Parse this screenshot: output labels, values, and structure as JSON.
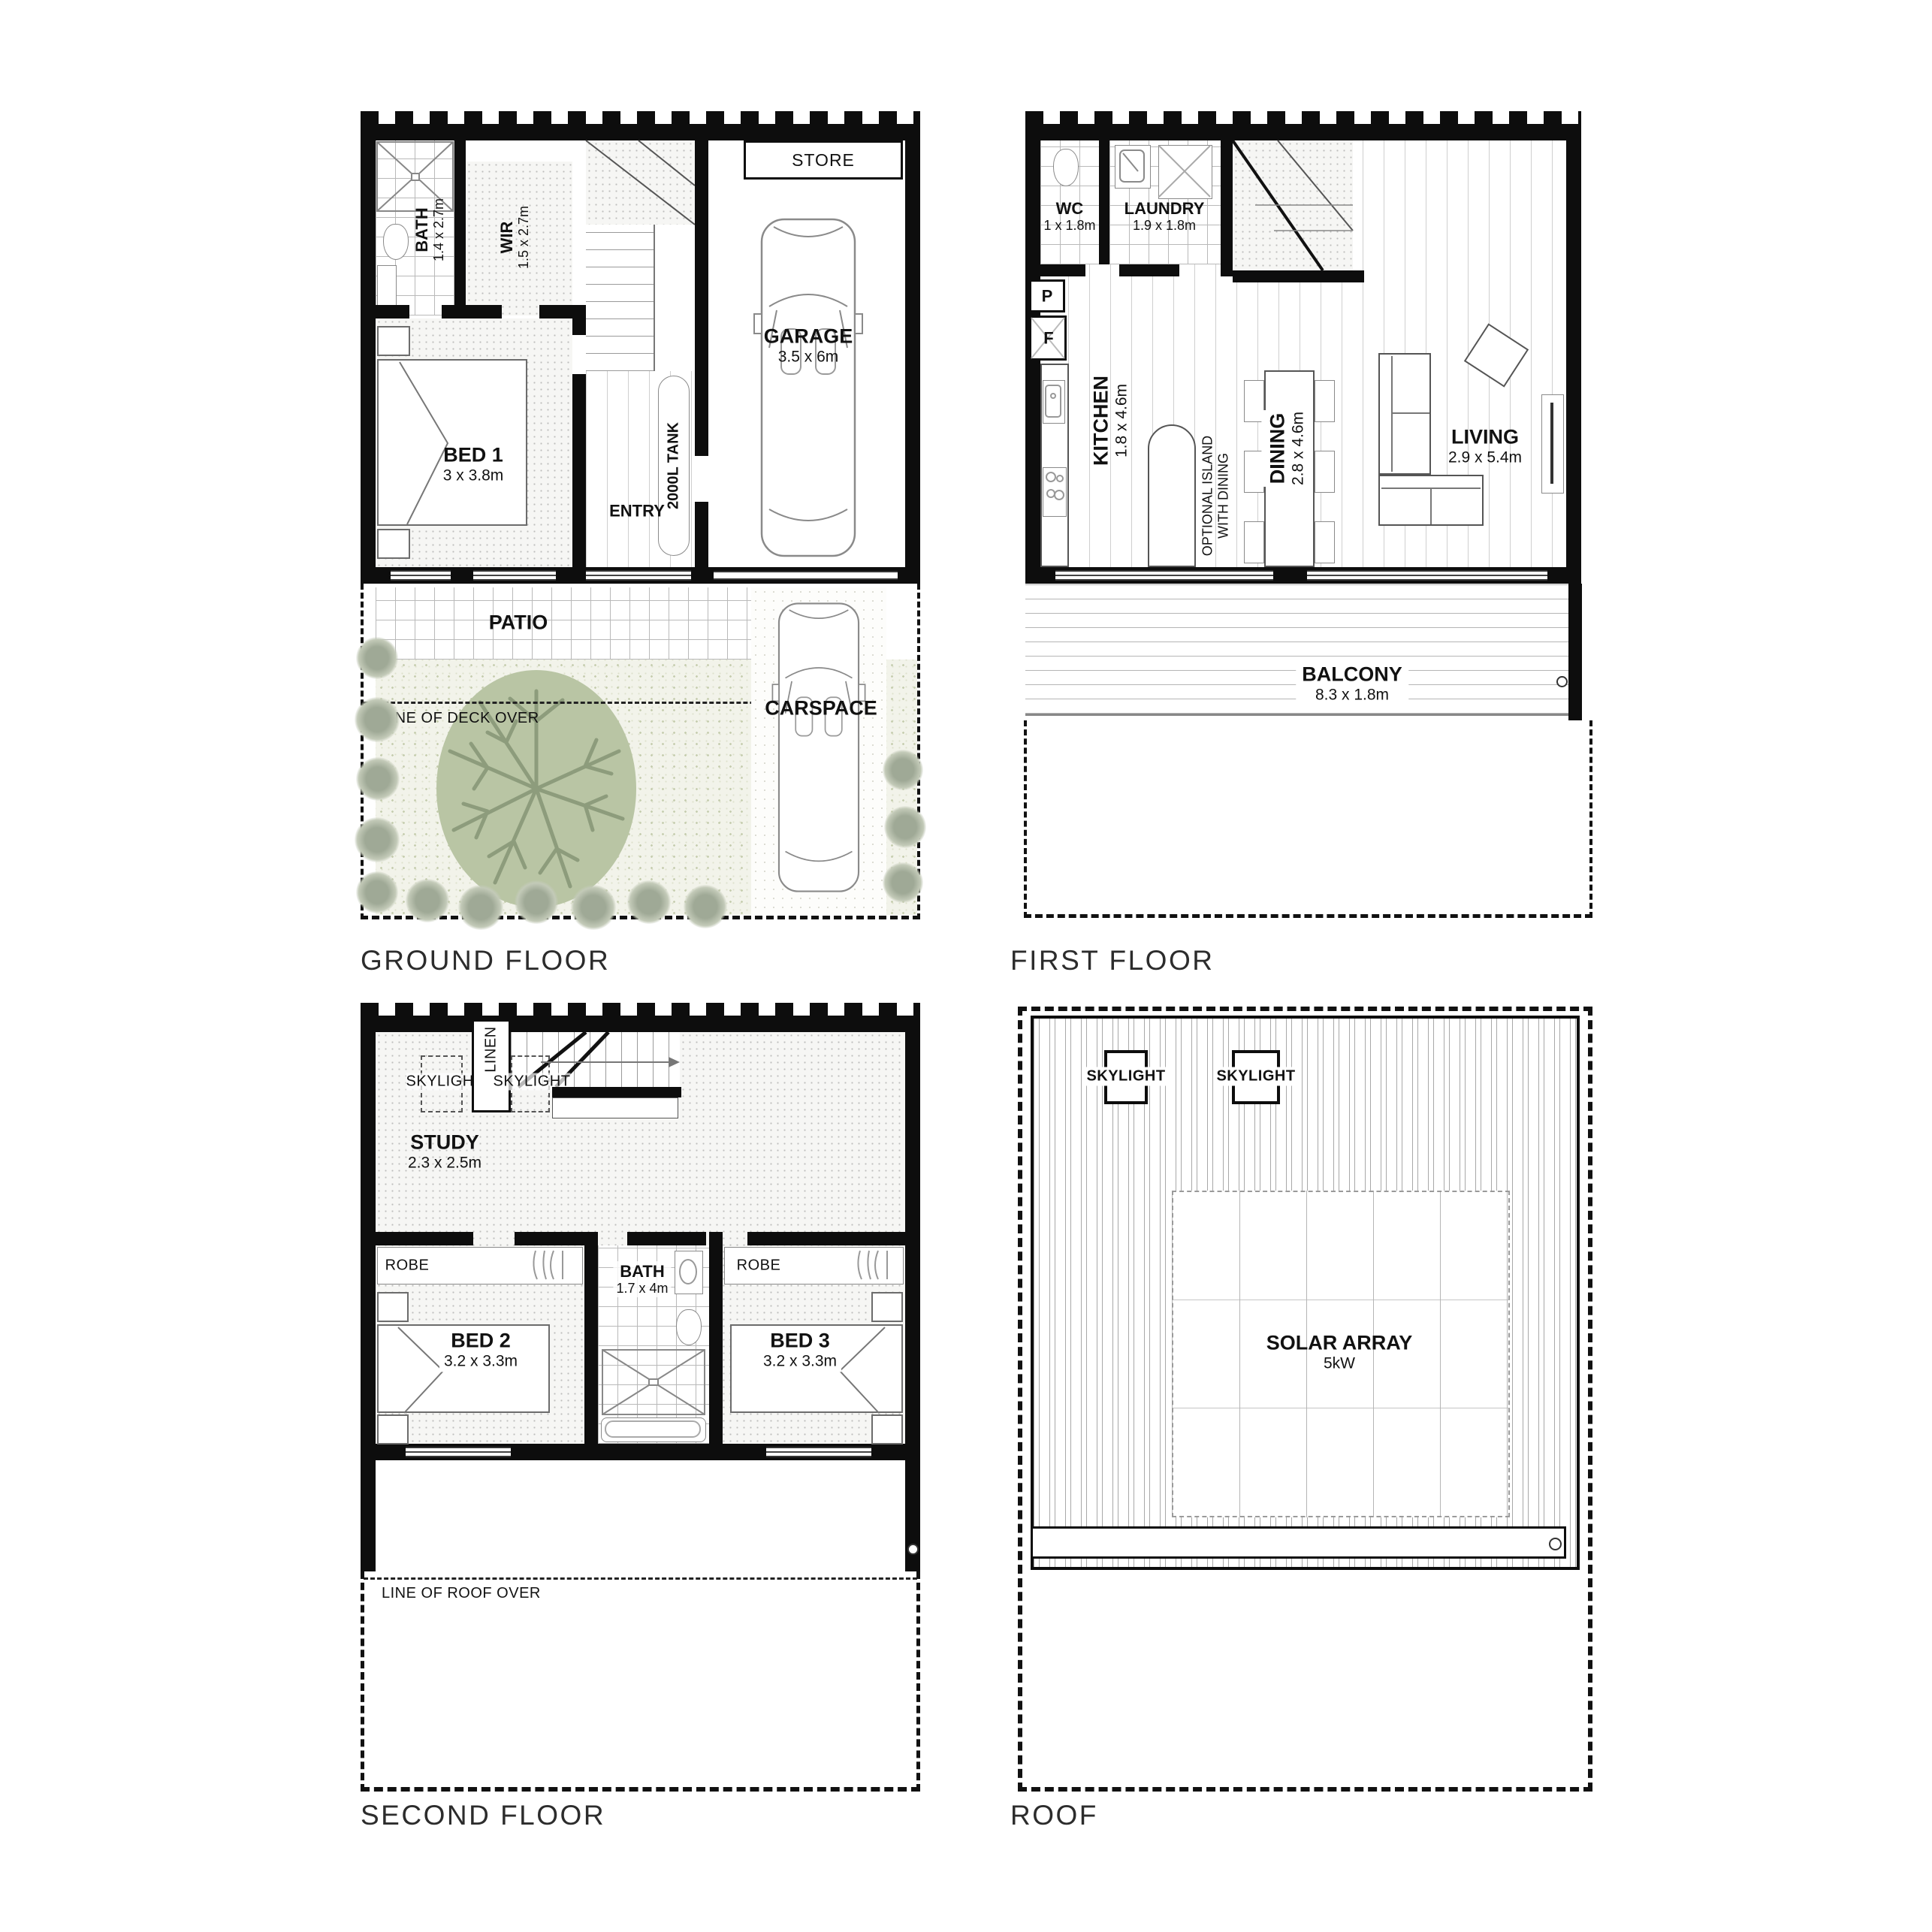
{
  "sheet_type": "residential floor plan set",
  "colors": {
    "wall": "#0d0d0d",
    "tree_fill": "#b9c5a4",
    "tree_branch": "#8d9c7c",
    "shrub": "#9fa996",
    "garden_tint": "#f2f3ea"
  },
  "floors": {
    "ground": {
      "title": "GROUND FLOOR",
      "bath": "BATH",
      "bath_dims": "1.4 x 2.7m",
      "wir": "WIR",
      "wir_dims": "1.5 x 2.7m",
      "store": "STORE",
      "tank": "2000L TANK",
      "garage": "GARAGE",
      "garage_dims": "3.5 x 6m",
      "bed1": "BED 1",
      "bed1_dims": "3 x 3.8m",
      "entry": "ENTRY",
      "patio": "PATIO",
      "deck_note": "LINE OF DECK OVER",
      "carspace": "CARSPACE"
    },
    "first": {
      "title": "FIRST FLOOR",
      "wc": "WC",
      "wc_dims": "1 x 1.8m",
      "laundry": "LAUNDRY",
      "laundry_dims": "1.9 x 1.8m",
      "pantry": "P",
      "fridge": "F",
      "kitchen": "KITCHEN",
      "kitchen_dims": "1.8 x 4.6m",
      "island_line1": "OPTIONAL ISLAND",
      "island_line2": "WITH DINING",
      "dining": "DINING",
      "dining_dims": "2.8 x 4.6m",
      "living": "LIVING",
      "living_dims": "2.9 x 5.4m",
      "balcony": "BALCONY",
      "balcony_dims": "8.3 x 1.8m"
    },
    "second": {
      "title": "SECOND FLOOR",
      "skylight": "SKYLIGHT",
      "linen": "LINEN",
      "study": "STUDY",
      "study_dims": "2.3 x 2.5m",
      "robe": "ROBE",
      "bed2": "BED 2",
      "bed2_dims": "3.2 x 3.3m",
      "bath": "BATH",
      "bath_dims": "1.7 x 4m",
      "bed3": "BED 3",
      "bed3_dims": "3.2 x 3.3m",
      "roof_note": "LINE OF ROOF OVER"
    },
    "roof": {
      "title": "ROOF",
      "skylight": "SKYLIGHT",
      "solar": "SOLAR ARRAY",
      "solar_kw": "5kW"
    }
  }
}
